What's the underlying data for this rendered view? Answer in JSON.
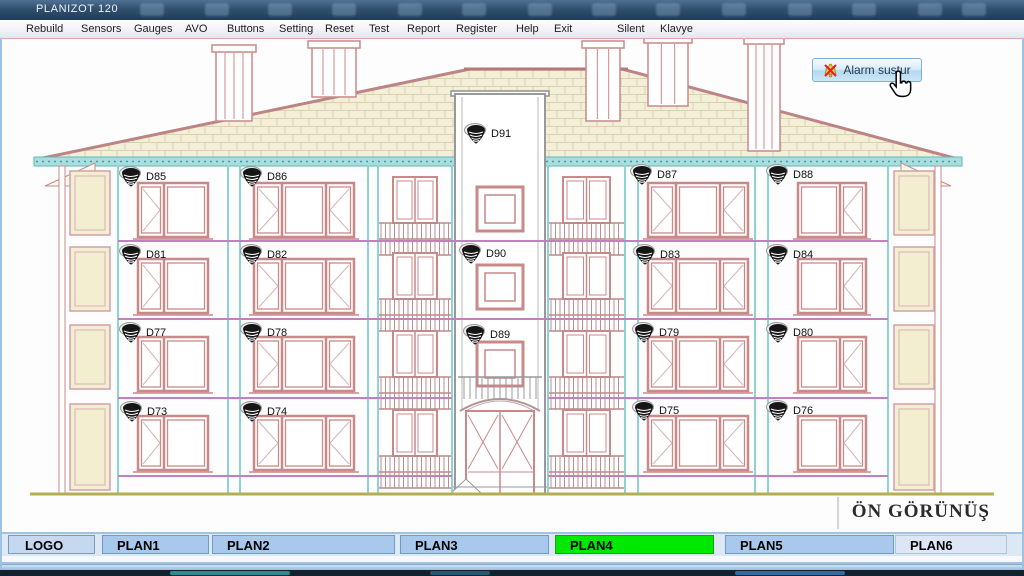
{
  "window": {
    "title": "PLANIZOT 120"
  },
  "menu": {
    "items": [
      "Rebuild",
      "Sensors",
      "Gauges",
      "AVO",
      "Buttons",
      "Setting",
      "Reset",
      "Test",
      "Report",
      "Register",
      "Help",
      "Exit",
      "Silent",
      "Klavye"
    ]
  },
  "alarm_button": {
    "label": "Alarm sustur",
    "icon": "bell-muted-icon"
  },
  "drawing": {
    "caption": "ÖN GÖRÜNÜŞ",
    "sensor_icon": "smoke-detector-icon",
    "sensors": [
      {
        "id": "D85",
        "x": 131,
        "y": 176
      },
      {
        "id": "D86",
        "x": 252,
        "y": 176
      },
      {
        "id": "D91",
        "x": 476,
        "y": 133
      },
      {
        "id": "D87",
        "x": 642,
        "y": 174
      },
      {
        "id": "D88",
        "x": 778,
        "y": 174
      },
      {
        "id": "D81",
        "x": 131,
        "y": 254
      },
      {
        "id": "D82",
        "x": 252,
        "y": 254
      },
      {
        "id": "D90",
        "x": 471,
        "y": 253
      },
      {
        "id": "D83",
        "x": 645,
        "y": 254
      },
      {
        "id": "D84",
        "x": 778,
        "y": 254
      },
      {
        "id": "D77",
        "x": 131,
        "y": 332
      },
      {
        "id": "D78",
        "x": 252,
        "y": 332
      },
      {
        "id": "D89",
        "x": 475,
        "y": 334
      },
      {
        "id": "D79",
        "x": 644,
        "y": 332
      },
      {
        "id": "D80",
        "x": 778,
        "y": 332
      },
      {
        "id": "D73",
        "x": 132,
        "y": 411
      },
      {
        "id": "D74",
        "x": 252,
        "y": 411
      },
      {
        "id": "D75",
        "x": 644,
        "y": 410
      },
      {
        "id": "D76",
        "x": 778,
        "y": 410
      }
    ]
  },
  "tabs": {
    "items": [
      {
        "label": "LOGO",
        "state": "logo"
      },
      {
        "label": "PLAN1",
        "state": "normal"
      },
      {
        "label": "PLAN2",
        "state": "normal"
      },
      {
        "label": "PLAN3",
        "state": "normal"
      },
      {
        "label": "PLAN4",
        "state": "active"
      },
      {
        "label": "PLAN5",
        "state": "normal"
      },
      {
        "label": "PLAN6",
        "state": "flat"
      }
    ],
    "colors": {
      "normal": "#a8c8ec",
      "active": "#00e800",
      "logo": "#c6d8f0",
      "flat": "#dce6f4"
    }
  }
}
